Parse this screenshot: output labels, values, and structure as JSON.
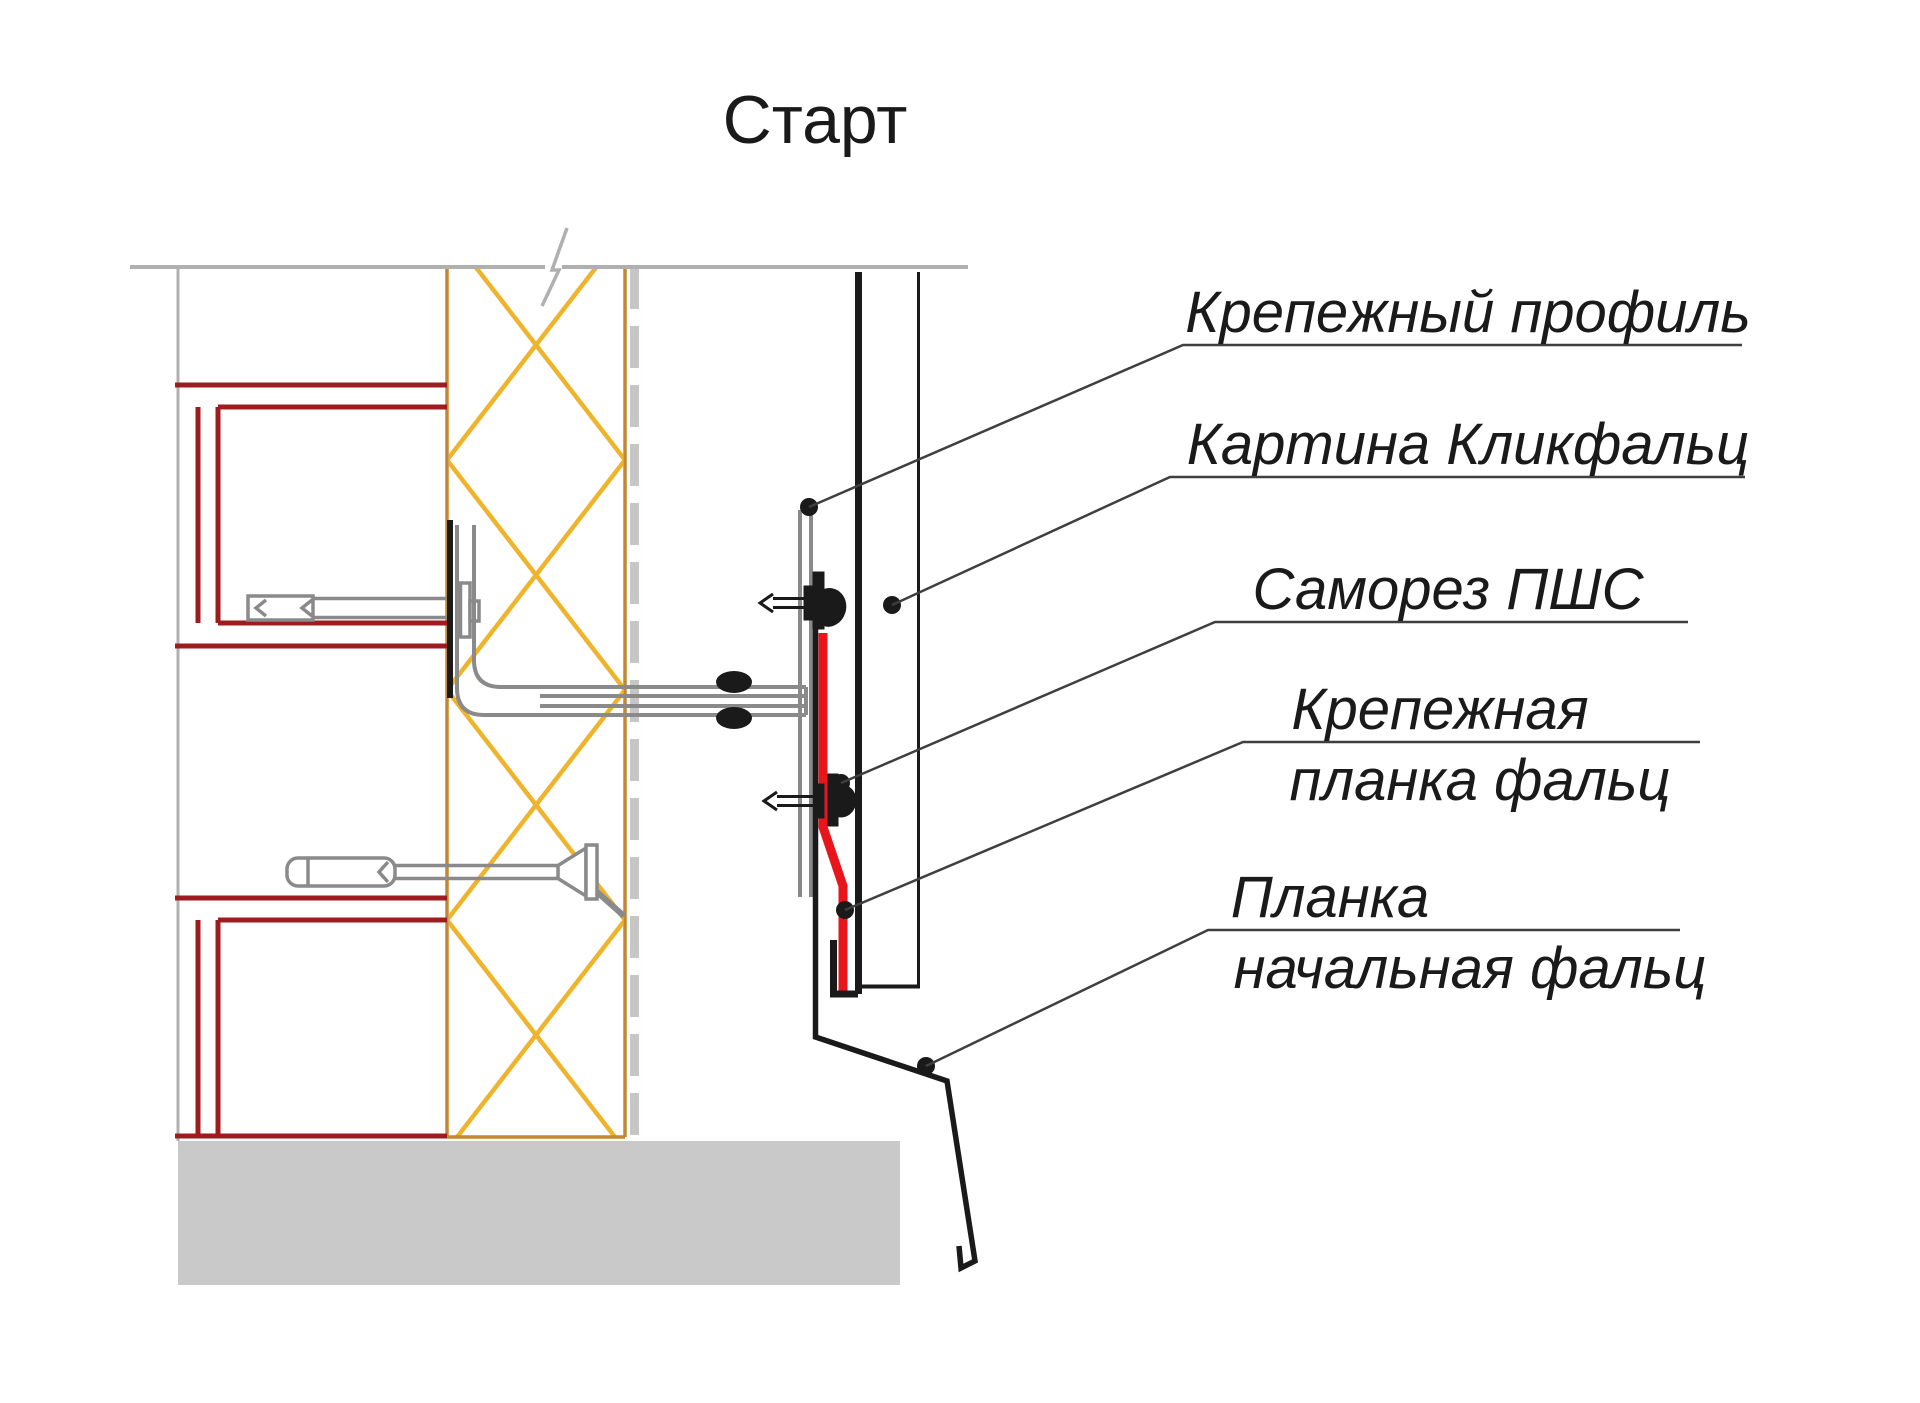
{
  "title": "Старт",
  "labels": [
    {
      "text": "Крепежный профиль"
    },
    {
      "text": "Картина Кликфальц"
    },
    {
      "text": "Саморез ПШС"
    },
    {
      "line1": "Крепежная",
      "line2": "планка фальц"
    },
    {
      "line1": "Планка",
      "line2": "начальная фальц"
    }
  ],
  "colors": {
    "black": "#1a1a1a",
    "leader": "#3f3f3f",
    "red_strip": "#e8151b",
    "dark_red": "#9e1b1f",
    "insulation_yellow": "#efb42c",
    "sheathing_brown": "#c4872e",
    "steel_gray": "#8a8a8a",
    "light_gray": "#b0b0b0",
    "membrane_gray": "#c6c6c6",
    "ground_gray": "#c9c9c9"
  }
}
